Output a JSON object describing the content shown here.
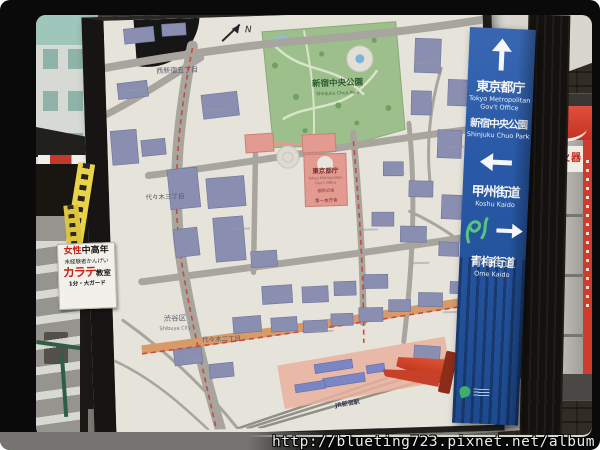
{
  "photo": {
    "watermark": "http://blueting723.pixnet.net/album"
  },
  "direction_sign": {
    "bg_color": "#2a5aa8",
    "up_jp1": "東京都庁",
    "up_en1": "Tokyo Metropolitan",
    "up_en2": "Gov't Office",
    "up_jp2": "新宿中央公園",
    "up_en3": "Shinjuku Chuo Park",
    "left_jp": "甲州街道",
    "left_en": "Koshu Kaido",
    "right_jp": "青梅街道",
    "right_en": "Ome Kaido"
  },
  "map": {
    "compass": "N",
    "park_color": "#9dbf8b",
    "building_color": "#8a8fb2",
    "highlight_color": "#e39a90",
    "labels": {
      "nishi_shinjuku_5chome": "西新宿五丁目",
      "shinjuku_chuo_park": "新宿中央公園",
      "shinjuku_chuo_park_en": "Shinjuku Chuo Park",
      "tocho": "東京都庁",
      "tocho_en1": "Tokyo Metropolitan",
      "tocho_en2": "Gov't Office",
      "tomin_hiroba": "都民広場",
      "dai1_honchosha": "第一本庁舎",
      "shibuya_ku": "渋谷区",
      "shibuya_en": "Shibuya City",
      "yoyogi_2chome": "代々木二丁目",
      "yoyogi_3chome": "代々木三丁目",
      "jr_shinjuku_sta": "JR新宿駅"
    }
  },
  "karate_poster": {
    "line1_red": "女性",
    "line1_black": "中高年",
    "line2": "未経験者かんげい",
    "line3_red": "カラテ",
    "line3_black": "教室",
    "line4": "1分・大ガード"
  },
  "fire_box": {
    "label": "火器"
  }
}
